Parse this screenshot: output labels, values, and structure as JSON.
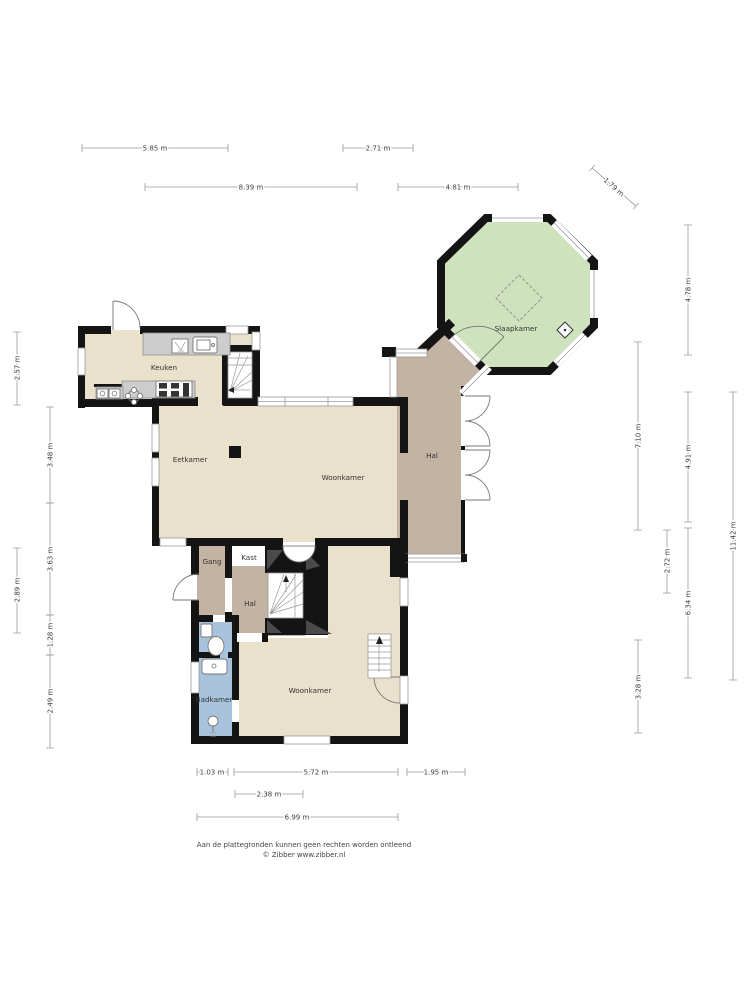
{
  "rooms": {
    "keuken": "Keuken",
    "eetkamer": "Eetkamer",
    "woonkamer_boven": "Woonkamer",
    "hal_boven": "Hal",
    "slaapkamer": "Slaapkamer",
    "gang": "Gang",
    "kast": "Kast",
    "hal_onder": "Hal",
    "badkamer": "Badkamer",
    "woonkamer_onder": "Woonkamer"
  },
  "dimensions": {
    "top": [
      "5.85 m",
      "2.71 m",
      "8.39 m",
      "4.81 m",
      "1.79 m"
    ],
    "left": [
      "2.57 m",
      "2.89 m",
      "3.48 m",
      "3.63 m",
      "1.28 m",
      "2.49 m"
    ],
    "right": [
      "4.78 m",
      "7.10 m",
      "4.91 m",
      "2.72 m",
      "6.34 m",
      "3.28 m",
      "11.42 m"
    ],
    "bottom": [
      "1.03 m",
      "5.72 m",
      "1.95 m",
      "2.38 m",
      "6.99 m"
    ]
  },
  "footer": {
    "disclaimer": "Aan de plattegronden kunnen geen rechten worden ontleend",
    "credit": "© Zibber www.zibber.nl"
  },
  "colors": {
    "wall": "#141414",
    "dark_wall": "#4a4a4a",
    "floor": "#e9e1cb",
    "hall": "#c2b3a3",
    "bedroom": "#cde2bd",
    "bathroom": "#a9c3dd",
    "closet": "#f4f4f2",
    "counter": "#cdcdcd",
    "dimension": "#9a9a9a"
  }
}
